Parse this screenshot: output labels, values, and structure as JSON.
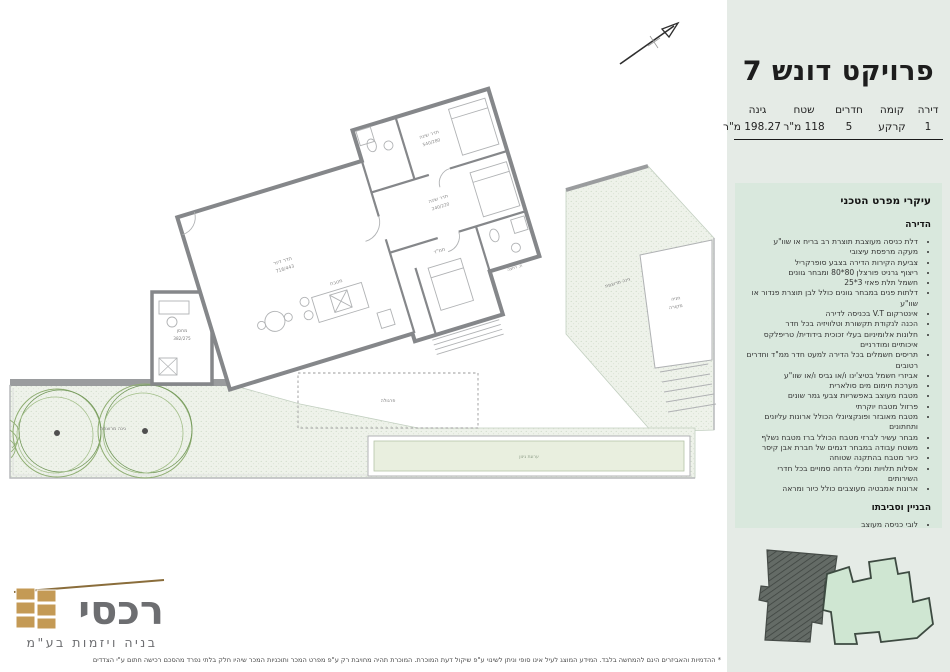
{
  "header": {
    "title": "פרויקט דונש 7"
  },
  "info_table": {
    "columns": [
      "דירה",
      "קומה",
      "חדרים",
      "שטח",
      "גינה"
    ],
    "values": [
      "1",
      "קרקע",
      "5",
      "118 מ\"ר",
      "198.27 מ\"ר"
    ]
  },
  "specs": {
    "title": "עיקרי מפרט הטכני",
    "sections": [
      {
        "title": "הדירה",
        "items": [
          "דלת כניסה מעוצבת תוצרת רב בריח או שוו\"ע",
          "מעקה מרפסת עיצובי",
          "צביעת הקירות הדירה בצבע סופרקריל",
          "ריצוף גרניט פורצלן 80*80 ומבחר גוונים",
          "חשמל תלת פאזי 3*25",
          "דלתות פנים במבחר גוונים כולל לבן תוצרת פנדור או שוו\"ע",
          "אינטרקום V.T בכניסה לדירה",
          "הכנה לנקודת תקשורת וטלוויזיה בכל חדר",
          "חלונות אלומיניום בעלי זכוכית בידודית/ טריפלקס איכותיים ומודרניים",
          "תריסים חשמלים בכל הדירה למעט חדר ממ\"ד וחדרים רטובים",
          "אביזרי חשמל בטיצ'ינו ו/או גביס ו/או שוו\"ע",
          "מערכת חימום מים סולארית",
          "מטבח מעוצב באפשריות צבעי גמר שונים",
          "פרזול מטבח יוקרתי",
          "מטבח מאובזר ופונקציונלי הכולל ארונות עליונים ותחתונים",
          "מבחר עשיר לברזי מטבח הכולל ברז מטבח נשלף",
          "משטח עבודה במבחר דגמים של חברת אבן קיסר",
          "כיור מטבח בהתקנה שטוחה",
          "אסלות תלויות ומכלי הדחה סמויים בכל חדרי השירותים",
          "ארונות אמבטיה מעוצבים כולל כיור ומראה"
        ]
      },
      {
        "title": "הבניין וסביבתו",
        "items": [
          "לובי כניסה מעוצב",
          "חיפוי הבניין בשילוב אבן",
          "חניה מקורה מוצמדת עבור כל דירה, גמר חניות בצבע אפוקסי או שוו\"ע",
          "לובי קומתי הכולל חיפויים עד גובה תקרה"
        ]
      }
    ]
  },
  "plan": {
    "labels": {
      "living": "חדר דיור",
      "living_dims": "716/443",
      "kitchen": "מטבח",
      "bedroom1": "חדר שינה",
      "bedroom1_dims": "540/280",
      "bedroom2": "חדר שינה",
      "bedroom2_dims": "240/220",
      "mamad": "ממ\"ד",
      "bath": "ח. רחצה",
      "storage": "מחסן",
      "storage_dims": "382/275",
      "parking1": "חניה",
      "parking2": "מקורה",
      "garden1": "גינה מרוצפת",
      "garden2": "גינה מרוצפת",
      "pergola": "פרגולה",
      "planter": "ערוגת גינון"
    }
  },
  "logo": {
    "name": "רכסי",
    "tagline": "בניה ויזמות בע\"מ"
  },
  "footer": {
    "disclaimer": "* ההדמיות והאביזרים הינם להמחשה בלבד. המידע המוצג לעיל אינו סופי וניתן לשינוי ע\"פ שיקול דעת המוכרת. המוכרת תהיה מחויבת רק ע\"פ מפרט המכר ותוכניות המכר שיהיו חלק בלתי נפרד מהסכם רכישה חתום ע\"י הצדדים"
  },
  "colors": {
    "right_column_bg": "#e5ebe6",
    "spec_panel_bg": "#d9e8dd",
    "wall_gray": "#85878a",
    "garden_green": "#eef2ea",
    "planter_green": "#e9efdf",
    "minimap_dark": "#646b66",
    "minimap_green": "#cfe6d2",
    "logo_gold": "#c49a55",
    "logo_gray": "#6d6e71"
  }
}
